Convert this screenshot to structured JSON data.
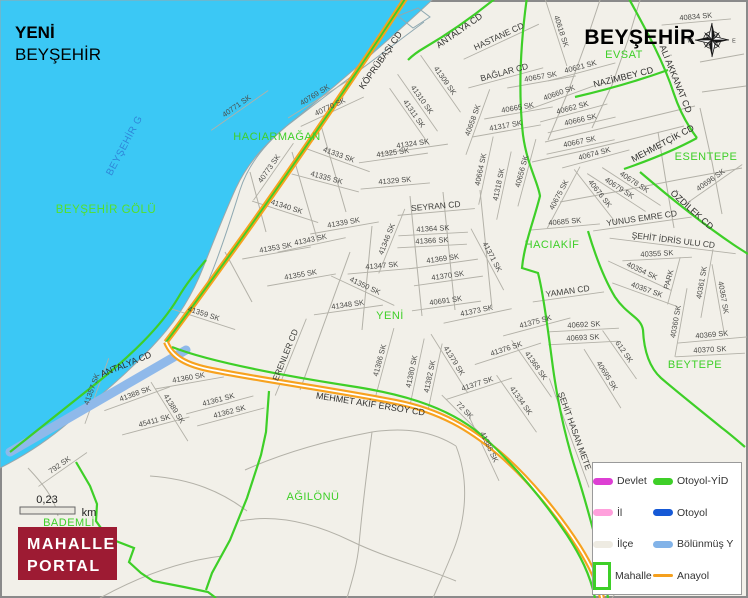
{
  "header": {
    "neighborhood": "YENİ",
    "district": "BEYŞEHİR",
    "city_label": "BEYŞEHİR"
  },
  "lake": {
    "label": {
      "text": "BEYŞEHİR GÖLÜ",
      "x": 106,
      "y": 213
    },
    "label_rotated": {
      "text": "BEYŞEHİR G",
      "x": 127,
      "y": 147,
      "rot": -62
    }
  },
  "scale": {
    "value": "0,23",
    "unit": "km"
  },
  "logo": {
    "line1": "MAHALLE",
    "line2": "PORTAL"
  },
  "legend": {
    "items": [
      {
        "label": "Devlet",
        "color": "#dd3fd3",
        "swatch": "thick"
      },
      {
        "label": "Otoyol-YİD",
        "color": "#3ecf28",
        "swatch": "thick"
      },
      {
        "label": "İl",
        "color": "#ffa0dc",
        "swatch": "thick"
      },
      {
        "label": "Otoyol",
        "color": "#1659d6",
        "swatch": "thick"
      },
      {
        "label": "İlçe",
        "color": "#eeebe2",
        "swatch": "thick"
      },
      {
        "label": "Bölünmüş Y",
        "color": "#82b3e8",
        "swatch": "thick"
      },
      {
        "label": "Mahalle",
        "color": "#3ecf28",
        "swatch": "box"
      },
      {
        "label": "Anayol",
        "color": "#f5a01e",
        "swatch": "thin"
      }
    ]
  },
  "areas": [
    {
      "name": "HACIARMAĞAN",
      "x": 277,
      "y": 140
    },
    {
      "name": "EVSAT",
      "x": 624,
      "y": 58
    },
    {
      "name": "ESENTEPE",
      "x": 706,
      "y": 160
    },
    {
      "name": "HACIAKİF",
      "x": 552,
      "y": 248
    },
    {
      "name": "YENİ",
      "x": 390,
      "y": 319
    },
    {
      "name": "BEYTEPE",
      "x": 695,
      "y": 368
    },
    {
      "name": "AĞILÖNÜ",
      "x": 313,
      "y": 500
    },
    {
      "name": "BADEMLİ",
      "x": 69,
      "y": 526
    }
  ],
  "streets": [
    {
      "name": "40771 SK",
      "x": 238,
      "y": 108,
      "rot": -35,
      "kind": "s"
    },
    {
      "name": "40769 SK",
      "x": 316,
      "y": 97,
      "rot": -32,
      "kind": "s"
    },
    {
      "name": "40770 SK",
      "x": 331,
      "y": 109,
      "rot": -25,
      "kind": "s"
    },
    {
      "name": "40773 SK",
      "x": 271,
      "y": 170,
      "rot": -55,
      "kind": "s"
    },
    {
      "name": "41333 SK",
      "x": 338,
      "y": 157,
      "rot": 20,
      "kind": "s"
    },
    {
      "name": "41335 SK",
      "x": 326,
      "y": 180,
      "rot": 15,
      "kind": "s"
    },
    {
      "name": "41340 SK",
      "x": 286,
      "y": 209,
      "rot": 18,
      "kind": "s"
    },
    {
      "name": "41339 SK",
      "x": 344,
      "y": 225,
      "rot": -10,
      "kind": "s"
    },
    {
      "name": "41343 SK",
      "x": 311,
      "y": 242,
      "rot": -12,
      "kind": "s"
    },
    {
      "name": "41353 SK",
      "x": 276,
      "y": 250,
      "rot": -10,
      "kind": "s"
    },
    {
      "name": "41355 SK",
      "x": 301,
      "y": 277,
      "rot": -10,
      "kind": "s"
    },
    {
      "name": "41359 SK",
      "x": 203,
      "y": 316,
      "rot": 18,
      "kind": "s"
    },
    {
      "name": "41324 SK",
      "x": 413,
      "y": 146,
      "rot": -8,
      "kind": "s"
    },
    {
      "name": "41325 SK",
      "x": 393,
      "y": 155,
      "rot": -8,
      "kind": "s"
    },
    {
      "name": "41329 SK",
      "x": 395,
      "y": 183,
      "rot": -5,
      "kind": "s"
    },
    {
      "name": "41309 SK",
      "x": 443,
      "y": 82,
      "rot": 55,
      "kind": "s"
    },
    {
      "name": "41310 SK",
      "x": 420,
      "y": 101,
      "rot": 55,
      "kind": "s"
    },
    {
      "name": "41311 SK",
      "x": 412,
      "y": 115,
      "rot": 55,
      "kind": "s"
    },
    {
      "name": "40657 SK",
      "x": 541,
      "y": 79,
      "rot": -10,
      "kind": "s"
    },
    {
      "name": "40618 SK",
      "x": 559,
      "y": 32,
      "rot": 72,
      "kind": "s"
    },
    {
      "name": "40621 SK",
      "x": 581,
      "y": 69,
      "rot": -15,
      "kind": "s"
    },
    {
      "name": "40834 SK",
      "x": 696,
      "y": 19,
      "rot": -5,
      "kind": "s"
    },
    {
      "name": "40658 SK",
      "x": 475,
      "y": 121,
      "rot": -70,
      "kind": "s"
    },
    {
      "name": "40665 SK",
      "x": 518,
      "y": 110,
      "rot": -10,
      "kind": "s"
    },
    {
      "name": "41317 SK",
      "x": 506,
      "y": 128,
      "rot": -10,
      "kind": "s"
    },
    {
      "name": "40664 SK",
      "x": 483,
      "y": 170,
      "rot": -78,
      "kind": "s"
    },
    {
      "name": "41318 SK",
      "x": 501,
      "y": 185,
      "rot": -78,
      "kind": "s"
    },
    {
      "name": "40656 SK",
      "x": 524,
      "y": 172,
      "rot": -75,
      "kind": "s"
    },
    {
      "name": "40660 SK",
      "x": 560,
      "y": 95,
      "rot": -20,
      "kind": "s"
    },
    {
      "name": "40662 SK",
      "x": 573,
      "y": 110,
      "rot": -15,
      "kind": "s"
    },
    {
      "name": "40666 SK",
      "x": 581,
      "y": 122,
      "rot": -13,
      "kind": "s"
    },
    {
      "name": "40667 SK",
      "x": 580,
      "y": 144,
      "rot": -12,
      "kind": "s"
    },
    {
      "name": "40674 SK",
      "x": 595,
      "y": 156,
      "rot": -15,
      "kind": "s"
    },
    {
      "name": "40678 SK",
      "x": 633,
      "y": 184,
      "rot": 33,
      "kind": "s"
    },
    {
      "name": "40679 SK",
      "x": 618,
      "y": 190,
      "rot": 33,
      "kind": "s"
    },
    {
      "name": "40675 SK",
      "x": 561,
      "y": 196,
      "rot": -62,
      "kind": "s"
    },
    {
      "name": "40676 SK",
      "x": 598,
      "y": 195,
      "rot": 52,
      "kind": "s"
    },
    {
      "name": "40685 SK",
      "x": 565,
      "y": 224,
      "rot": -5,
      "kind": "s"
    },
    {
      "name": "40696 SK",
      "x": 712,
      "y": 182,
      "rot": -35,
      "kind": "s"
    },
    {
      "name": "40355 SK",
      "x": 657,
      "y": 256,
      "rot": -3,
      "kind": "s"
    },
    {
      "name": "40354 SK",
      "x": 641,
      "y": 273,
      "rot": 25,
      "kind": "s"
    },
    {
      "name": "40357 SK",
      "x": 646,
      "y": 292,
      "rot": 20,
      "kind": "s"
    },
    {
      "name": "PARK",
      "x": 671,
      "y": 280,
      "rot": -75,
      "kind": "s"
    },
    {
      "name": "40360 SK",
      "x": 678,
      "y": 322,
      "rot": -80,
      "kind": "s"
    },
    {
      "name": "40361 SK",
      "x": 704,
      "y": 283,
      "rot": -80,
      "kind": "s"
    },
    {
      "name": "40367 SK",
      "x": 721,
      "y": 298,
      "rot": 80,
      "kind": "s"
    },
    {
      "name": "40369 SK",
      "x": 712,
      "y": 337,
      "rot": -5,
      "kind": "s"
    },
    {
      "name": "40370 SK",
      "x": 710,
      "y": 352,
      "rot": -3,
      "kind": "s"
    },
    {
      "name": "40692 SK",
      "x": 584,
      "y": 327,
      "rot": -3,
      "kind": "s"
    },
    {
      "name": "40693 SK",
      "x": 583,
      "y": 340,
      "rot": -3,
      "kind": "s"
    },
    {
      "name": "612 SK",
      "x": 622,
      "y": 353,
      "rot": 55,
      "kind": "s"
    },
    {
      "name": "40695 SK",
      "x": 605,
      "y": 377,
      "rot": 58,
      "kind": "s"
    },
    {
      "name": "41364 SK",
      "x": 433,
      "y": 231,
      "rot": -3,
      "kind": "s"
    },
    {
      "name": "41366 SK",
      "x": 432,
      "y": 243,
      "rot": -3,
      "kind": "s"
    },
    {
      "name": "41369 SK",
      "x": 443,
      "y": 261,
      "rot": -8,
      "kind": "s"
    },
    {
      "name": "41370 SK",
      "x": 448,
      "y": 278,
      "rot": -8,
      "kind": "s"
    },
    {
      "name": "40691 SK",
      "x": 446,
      "y": 303,
      "rot": -8,
      "kind": "s"
    },
    {
      "name": "41371 SK",
      "x": 490,
      "y": 258,
      "rot": 62,
      "kind": "s"
    },
    {
      "name": "41373 SK",
      "x": 477,
      "y": 313,
      "rot": -12,
      "kind": "s"
    },
    {
      "name": "41375 SK",
      "x": 536,
      "y": 324,
      "rot": -15,
      "kind": "s"
    },
    {
      "name": "41376 SK",
      "x": 507,
      "y": 351,
      "rot": -18,
      "kind": "s"
    },
    {
      "name": "41368 SK",
      "x": 534,
      "y": 367,
      "rot": 55,
      "kind": "s"
    },
    {
      "name": "41334 SK",
      "x": 519,
      "y": 402,
      "rot": 55,
      "kind": "s"
    },
    {
      "name": "41346 SK",
      "x": 389,
      "y": 240,
      "rot": -68,
      "kind": "s"
    },
    {
      "name": "41347 SK",
      "x": 382,
      "y": 268,
      "rot": -5,
      "kind": "s"
    },
    {
      "name": "41350 SK",
      "x": 364,
      "y": 288,
      "rot": 25,
      "kind": "s"
    },
    {
      "name": "41348 SK",
      "x": 348,
      "y": 307,
      "rot": -8,
      "kind": "s"
    },
    {
      "name": "41360 SK",
      "x": 189,
      "y": 380,
      "rot": -10,
      "kind": "s"
    },
    {
      "name": "41388 SK",
      "x": 136,
      "y": 396,
      "rot": -20,
      "kind": "s"
    },
    {
      "name": "45411 SK",
      "x": 155,
      "y": 423,
      "rot": -15,
      "kind": "s"
    },
    {
      "name": "41389 SK",
      "x": 172,
      "y": 410,
      "rot": 58,
      "kind": "s"
    },
    {
      "name": "41361 SK",
      "x": 219,
      "y": 402,
      "rot": -15,
      "kind": "s"
    },
    {
      "name": "41362 SK",
      "x": 230,
      "y": 414,
      "rot": -15,
      "kind": "s"
    },
    {
      "name": "41357 SK",
      "x": 94,
      "y": 390,
      "rot": -70,
      "kind": "s"
    },
    {
      "name": "41386 SK",
      "x": 382,
      "y": 361,
      "rot": -75,
      "kind": "s"
    },
    {
      "name": "41380 SK",
      "x": 414,
      "y": 372,
      "rot": -78,
      "kind": "s"
    },
    {
      "name": "41382 SK",
      "x": 432,
      "y": 377,
      "rot": -78,
      "kind": "s"
    },
    {
      "name": "41379 SK",
      "x": 452,
      "y": 362,
      "rot": 58,
      "kind": "s"
    },
    {
      "name": "41377 SK",
      "x": 478,
      "y": 386,
      "rot": -18,
      "kind": "s"
    },
    {
      "name": "72 SK",
      "x": 463,
      "y": 412,
      "rot": 45,
      "kind": "s"
    },
    {
      "name": "41385 SK",
      "x": 487,
      "y": 448,
      "rot": 65,
      "kind": "s"
    },
    {
      "name": "792 SK",
      "x": 61,
      "y": 467,
      "rot": -35,
      "kind": "s"
    },
    {
      "name": "HASTANE CD",
      "x": 500,
      "y": 39,
      "rot": -25,
      "kind": "cd"
    },
    {
      "name": "BAĞLAR CD",
      "x": 505,
      "y": 75,
      "rot": -15,
      "kind": "cd"
    },
    {
      "name": "SEYRAN CD",
      "x": 436,
      "y": 209,
      "rot": -5,
      "kind": "cd"
    },
    {
      "name": "YAMAN CD",
      "x": 568,
      "y": 294,
      "rot": -8,
      "kind": "cd"
    },
    {
      "name": "ERENLER CD",
      "x": 288,
      "y": 356,
      "rot": -68,
      "kind": "cd"
    },
    {
      "name": "YUNUS EMRE CD",
      "x": 642,
      "y": 221,
      "rot": -8,
      "kind": "cd"
    },
    {
      "name": "ŞEHİT İDRİS ULU CD",
      "x": 673,
      "y": 243,
      "rot": 7,
      "kind": "cd"
    },
    {
      "name": "ŞEHİT HASAN METE",
      "x": 572,
      "y": 432,
      "rot": 70,
      "kind": "cd"
    },
    {
      "name": "KÖPRÜBAŞI CD",
      "x": 383,
      "y": 62,
      "rot": -55,
      "kind": "r"
    },
    {
      "name": "ANTALYA CD",
      "x": 461,
      "y": 33,
      "rot": -35,
      "kind": "r"
    },
    {
      "name": "NAZİMBEY CD",
      "x": 624,
      "y": 80,
      "rot": -14,
      "kind": "r"
    },
    {
      "name": "ALİ AKKANAT CD",
      "x": 673,
      "y": 80,
      "rot": 68,
      "kind": "r"
    },
    {
      "name": "MEHMETÇİK CD",
      "x": 664,
      "y": 146,
      "rot": -28,
      "kind": "r"
    },
    {
      "name": "ÖZDİLEK CD",
      "x": 690,
      "y": 212,
      "rot": 42,
      "kind": "r"
    },
    {
      "name": "MEHMET AKİF ERSOY CD",
      "x": 370,
      "y": 407,
      "rot": 9,
      "kind": "r"
    },
    {
      "name": "ANTALYA CD",
      "x": 127,
      "y": 367,
      "rot": -22,
      "kind": "r"
    }
  ],
  "colors": {
    "water": "#3bc8f5",
    "land": "#f2f0e9",
    "green": "#3ecf28",
    "orange": "#f7a21f",
    "blueroad": "#8fb9ea",
    "streetline": "#b3b1a8",
    "logobg": "#9d1b33"
  }
}
